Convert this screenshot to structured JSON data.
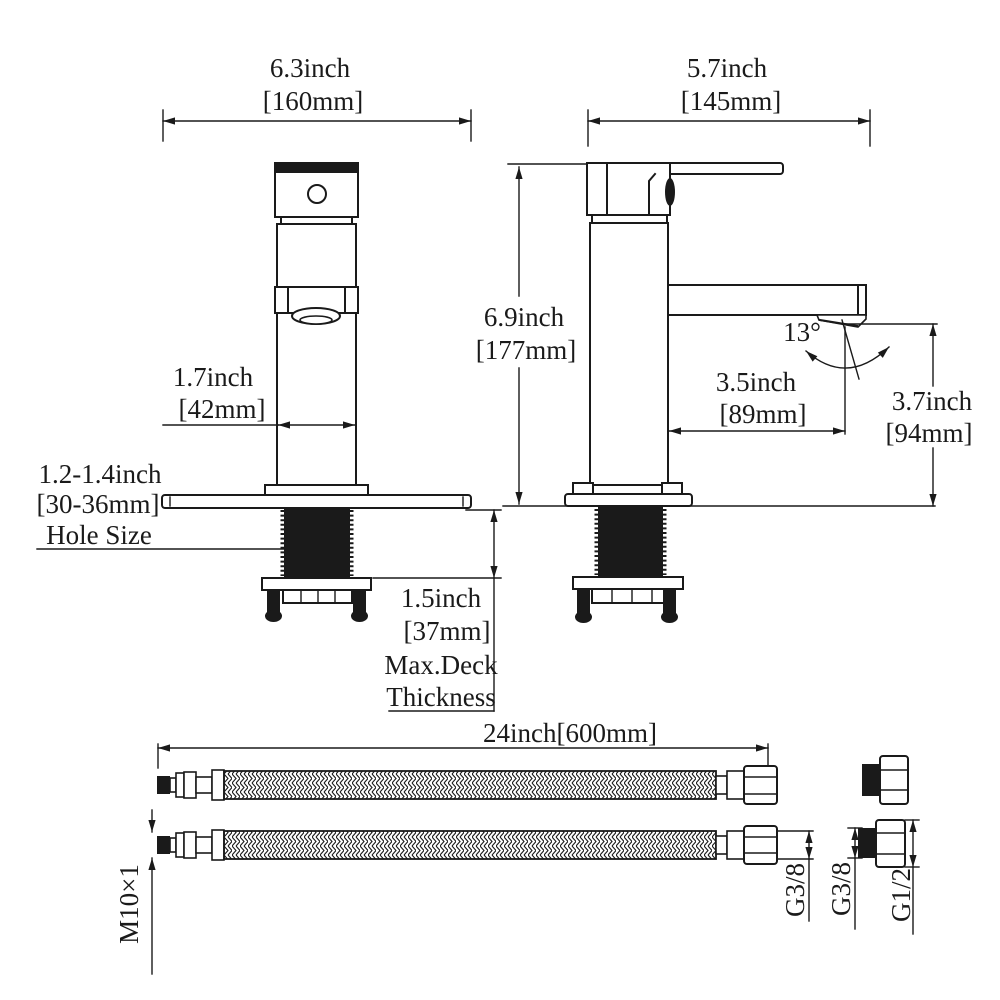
{
  "meta": {
    "ink_color": "#1a1a1a",
    "background_color": "#ffffff",
    "drawing_type": "faucet-dimension-diagram"
  },
  "front_view": {
    "width_in": "6.3inch",
    "width_mm": "[160mm]",
    "body_width_in": "1.7inch",
    "body_width_mm": "[42mm]",
    "hole_size_line1": "1.2-1.4inch",
    "hole_size_line2": "[30-36mm]",
    "hole_size_line3": "Hole Size",
    "deck_in": "1.5inch",
    "deck_mm": "[37mm]",
    "deck_note1": "Max.Deck",
    "deck_note2": "Thickness"
  },
  "side_view": {
    "depth_in": "5.7inch",
    "depth_mm": "[145mm]",
    "height_in": "6.9inch",
    "height_mm": "[177mm]",
    "spout_angle": "13°",
    "reach_in": "3.5inch",
    "reach_mm": "[89mm]",
    "spout_height_in": "3.7inch",
    "spout_height_mm": "[94mm]"
  },
  "hoses": {
    "length_label": "24inch[600mm]",
    "inlet_thread": "M10×1",
    "hose_nut_thread": "G3/8",
    "adapter_inlet_thread": "G3/8",
    "adapter_outlet_thread": "G1/2"
  }
}
